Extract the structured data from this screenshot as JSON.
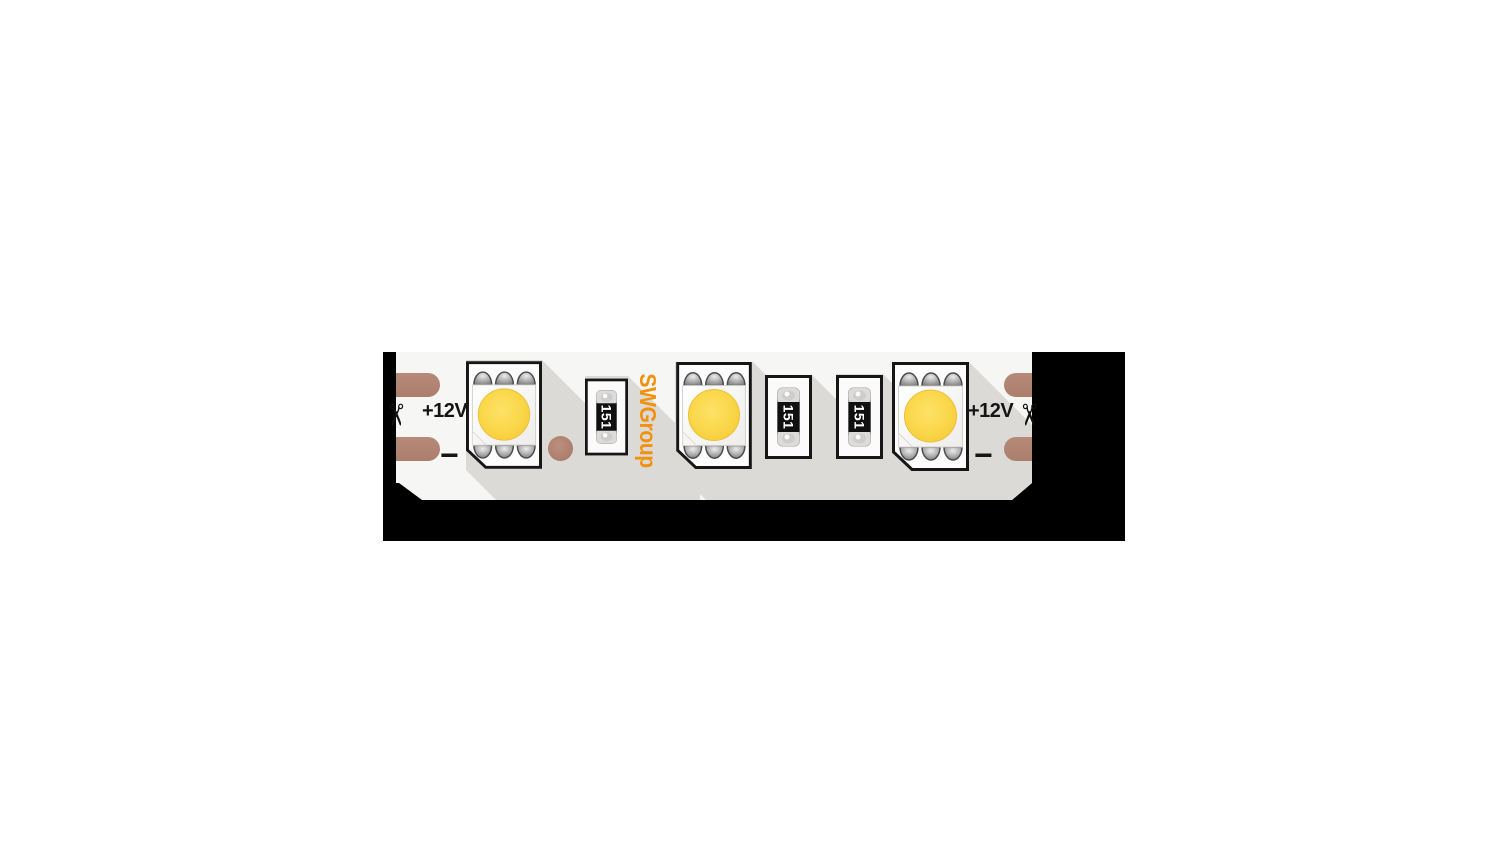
{
  "product": {
    "brand_logo": "SWGroup",
    "voltage_label": "+12V",
    "negative_label": "−",
    "resistor_code": "151"
  },
  "icons": {
    "cut_mark": "✂"
  },
  "components": {
    "led_count": 3,
    "resistor_count": 3,
    "solder_pad_count": 4,
    "via_count": 1,
    "cut_mark_count": 2
  },
  "colors": {
    "backdrop_black": "#000000",
    "pcb_white": "#f6f6f5",
    "copper_pad_brown": "#b08374",
    "led_yellow": "#fbd94e",
    "brand_orange": "#f1920e",
    "shadow_gray": "#dcdad7",
    "silkscreen_black": "#151515",
    "resistor_label_white": "#ffffff"
  }
}
